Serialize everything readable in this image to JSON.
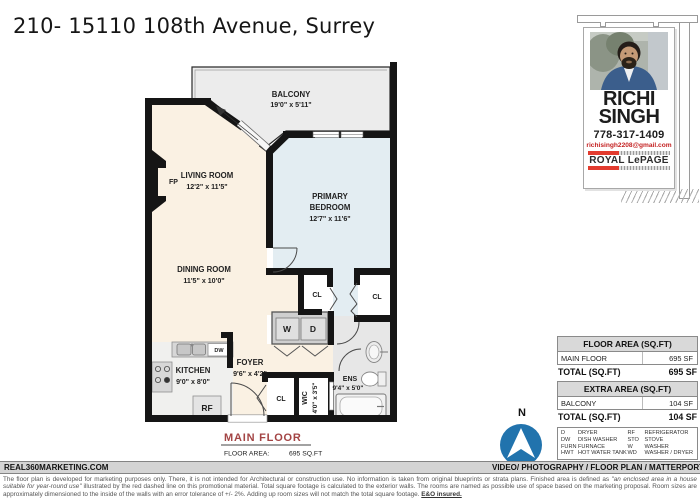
{
  "title": "210- 15110 108th Avenue, Surrey",
  "plan": {
    "rooms": {
      "balcony": {
        "name": "BALCONY",
        "dims": "19'0\" x 5'11\""
      },
      "living_room": {
        "name": "LIVING ROOM",
        "dims": "12'2\" x 11'5\""
      },
      "primary_bedroom": {
        "name1": "PRIMARY",
        "name2": "BEDROOM",
        "dims": "12'7\" x 11'6\""
      },
      "dining_room": {
        "name": "DINING ROOM",
        "dims": "11'5\" x 10'0\""
      },
      "kitchen": {
        "name": "KITCHEN",
        "dims": "9'0\" x 8'0\""
      },
      "foyer": {
        "name": "FOYER",
        "dims": "9'6\" x 4'2\""
      },
      "wic": {
        "name": "WIC",
        "dims": "4'0\" x 3'5\""
      },
      "ensuite": {
        "name": "ENS",
        "dims": "9'4\" x 5'0\""
      }
    },
    "tags": {
      "closet": "CL",
      "fireplace": "FP",
      "washer": "W",
      "dryer": "D",
      "dishwasher": "DW",
      "fridge": "RF"
    },
    "caption": {
      "floor_name": "MAIN FLOOR",
      "area_label": "FLOOR AREA:",
      "area_value": "695 SQ.FT"
    }
  },
  "agent_sign": {
    "first_name": "RICHI",
    "last_name": "SINGH",
    "phone": "778-317-1409",
    "email": "richisingh2208@gmail.com",
    "brokerage": "ROYAL LePAGE"
  },
  "area_tables": [
    {
      "header": "FLOOR AREA (SQ.FT)",
      "rows": [
        {
          "label": "MAIN FLOOR",
          "value": "695 SF"
        }
      ],
      "total_label": "TOTAL (SQ.FT)",
      "total_value": "695 SF"
    },
    {
      "header": "EXTRA AREA (SQ.FT)",
      "rows": [
        {
          "label": "BALCONY",
          "value": "104 SF"
        }
      ],
      "total_label": "TOTAL (SQ.FT)",
      "total_value": "104 SF"
    }
  ],
  "legend": {
    "left": [
      {
        "abbr": "D",
        "term": "DRYER"
      },
      {
        "abbr": "DW",
        "term": "DISH WASHER"
      },
      {
        "abbr": "FURN",
        "term": "FURNACE"
      },
      {
        "abbr": "HWT",
        "term": "HOT WATER TANK"
      }
    ],
    "right": [
      {
        "abbr": "RF",
        "term": "REFRIGERATOR"
      },
      {
        "abbr": "STO",
        "term": "STOVE"
      },
      {
        "abbr": "W",
        "term": "WASHER"
      },
      {
        "abbr": "WD",
        "term": "WASHER / DRYER"
      }
    ]
  },
  "compass": {
    "north": "N"
  },
  "footer_bar": {
    "left": "REAL360MARKETING.COM",
    "right": "VIDEO/ PHOTOGRAPHY / FLOOR PLAN / MATTERPORT"
  },
  "disclaimer": {
    "part1": "The floor plan is developed for marketing purposes only. There, it is not intended for Architectural or construction use. No information is taken from original blueprints or strata plans. Finished area is defined as ",
    "italic": "\"an enclosed area in a house suitable for year-round use\"",
    "part2": " illustrated by the red dashed line on this promotional material. Total square footage is calculated to the exterior walls. The rooms are named as possible use of space based on the marketing proposal. Room sizes are approximately dimensioned to the inside of the walls with an error tolerance of +/- 2%. Adding up room sizes will not match the total square footage. ",
    "eo": "E&O insured."
  },
  "colors": {
    "accent_red": "#a34444",
    "brand_red": "#e23b2e",
    "compass_blue": "#2173ad",
    "bedroom_fill": "#e3edf2",
    "floor_fill": "#faf1e3",
    "balcony_fill": "#ececec",
    "wall": "#151515"
  }
}
